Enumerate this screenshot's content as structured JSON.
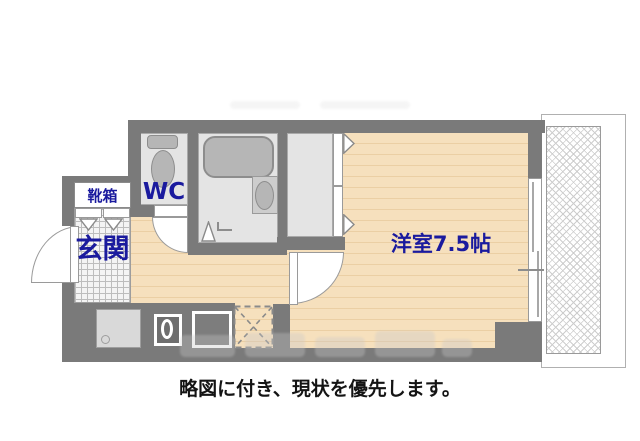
{
  "floorplan": {
    "labels": {
      "shoe_box": "靴箱",
      "wc": "WC",
      "entrance": "玄関",
      "main_room": "洋室7.5帖"
    },
    "caption": "略図に付き、現状を優先します。",
    "colors": {
      "wall": "#7a7a7a",
      "wood_floor": "#f6e0bd",
      "wood_stripe": "#ebcfa4",
      "room_floor": "#e4e4e4",
      "tile_floor": "#f4f4f4",
      "tile_line": "#bdbdbd",
      "fixture_fill": "#b6b6b6",
      "fixture_line": "#8d8d8d",
      "label_text": "#1a1a9e",
      "caption_text": "#141414"
    }
  }
}
